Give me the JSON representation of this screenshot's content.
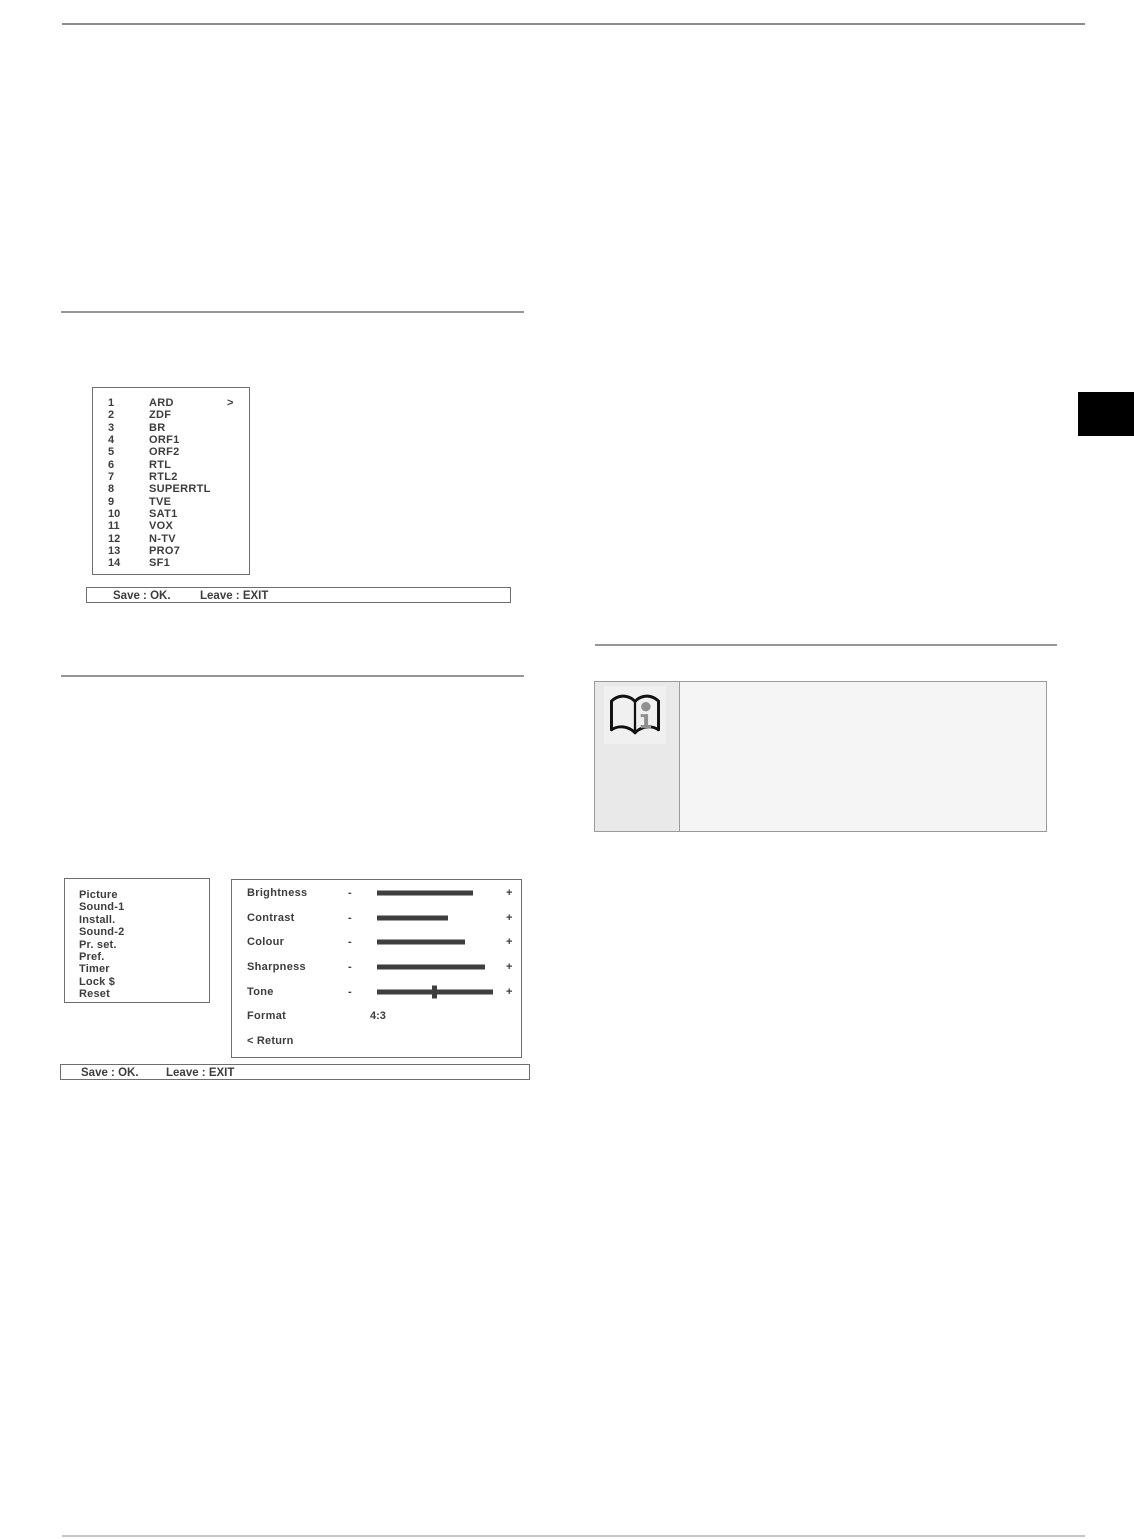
{
  "osd_channel_list": {
    "channels": [
      {
        "num": "1",
        "name": "ARD",
        "cursor": ">"
      },
      {
        "num": "2",
        "name": "ZDF",
        "cursor": ""
      },
      {
        "num": "3",
        "name": "BR",
        "cursor": ""
      },
      {
        "num": "4",
        "name": "ORF1",
        "cursor": ""
      },
      {
        "num": "5",
        "name": "ORF2",
        "cursor": ""
      },
      {
        "num": "6",
        "name": "RTL",
        "cursor": ""
      },
      {
        "num": "7",
        "name": "RTL2",
        "cursor": ""
      },
      {
        "num": "8",
        "name": "SUPERRTL",
        "cursor": ""
      },
      {
        "num": "9",
        "name": "TVE",
        "cursor": ""
      },
      {
        "num": "10",
        "name": "SAT1",
        "cursor": ""
      },
      {
        "num": "11",
        "name": "VOX",
        "cursor": ""
      },
      {
        "num": "12",
        "name": "N-TV",
        "cursor": ""
      },
      {
        "num": "13",
        "name": "PRO7",
        "cursor": ""
      },
      {
        "num": "14",
        "name": "SF1",
        "cursor": ""
      }
    ]
  },
  "osd_footer": {
    "save_label": "Save : OK.",
    "leave_label": "Leave : EXIT"
  },
  "osd_picture_menu": {
    "sections": [
      "Picture",
      "Sound-1",
      "Install.",
      "Sound-2",
      "Pr. set.",
      "Pref.",
      "Timer",
      "Lock $",
      "Reset"
    ],
    "minus_label": "-",
    "plus_label": "+",
    "sliders": [
      {
        "label": "Brightness",
        "value_pct": 83
      },
      {
        "label": "Contrast",
        "value_pct": 61
      },
      {
        "label": "Colour",
        "value_pct": 76
      },
      {
        "label": "Sharpness",
        "value_pct": 93
      },
      {
        "label": "Tone",
        "value_pct": 100,
        "handle_pct": 49
      }
    ],
    "format_label": "Format",
    "format_value": "4:3",
    "return_label": "< Return"
  },
  "note": {
    "icon": "book-info-icon",
    "icon_color": "#111111",
    "icon_i_color": "#909090"
  },
  "colors": {
    "osd_text": "#3d3d3d",
    "rule_dark": "#8c8c8c",
    "rule_light": "#c6c6c6",
    "note_left_bg": "#e9e9e9",
    "note_right_bg": "#f5f5f5",
    "tab_black": "#000000"
  }
}
